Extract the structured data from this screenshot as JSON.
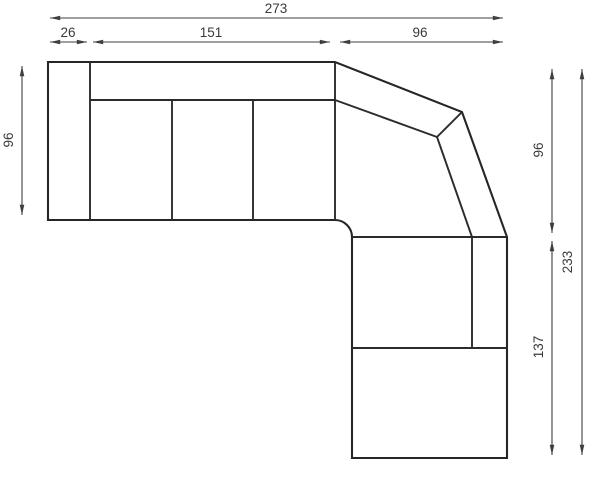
{
  "diagram": {
    "kind": "technical-drawing",
    "subject": "corner-sectional-sofa-top-view-plan",
    "background_color": "#ffffff",
    "outline_color": "#262626",
    "dimension_color": "#3f3f3f",
    "text_color": "#3a3a3a"
  },
  "dimensions": {
    "top_total_width": "273",
    "top_armrest_width": "26",
    "top_seats_width": "151",
    "top_corner_width": "96",
    "left_depth": "96",
    "right_upper_depth": "96",
    "right_lower_length": "137",
    "right_total_length": "233"
  }
}
